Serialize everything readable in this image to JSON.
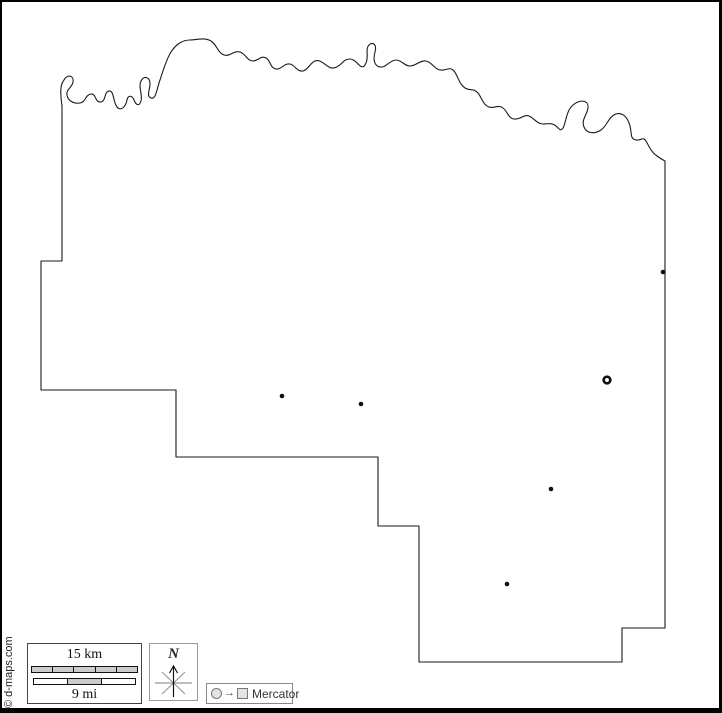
{
  "watermark": {
    "text": "© d-maps.com"
  },
  "legend": {
    "scale": {
      "km_label": "15 km",
      "mi_label": "9 mi",
      "km_segments": 5,
      "mi_segments": 3
    },
    "compass": {
      "north_label": "N"
    },
    "projection": {
      "label": "Mercator"
    }
  },
  "map": {
    "markers": {
      "towns": [
        {
          "x": 282,
          "y": 396
        },
        {
          "x": 361,
          "y": 404
        },
        {
          "x": 551,
          "y": 489
        },
        {
          "x": 507,
          "y": 584
        },
        {
          "x": 663,
          "y": 272
        }
      ],
      "town_radius": 2.3,
      "seat": {
        "x": 607,
        "y": 380,
        "radius": 3.3,
        "ring_width": 2.7
      }
    }
  },
  "colors": {
    "line": "#1a1a1a",
    "marker": "#111111",
    "compass_gray": "#999999",
    "segment_fill": "#cccccc"
  }
}
